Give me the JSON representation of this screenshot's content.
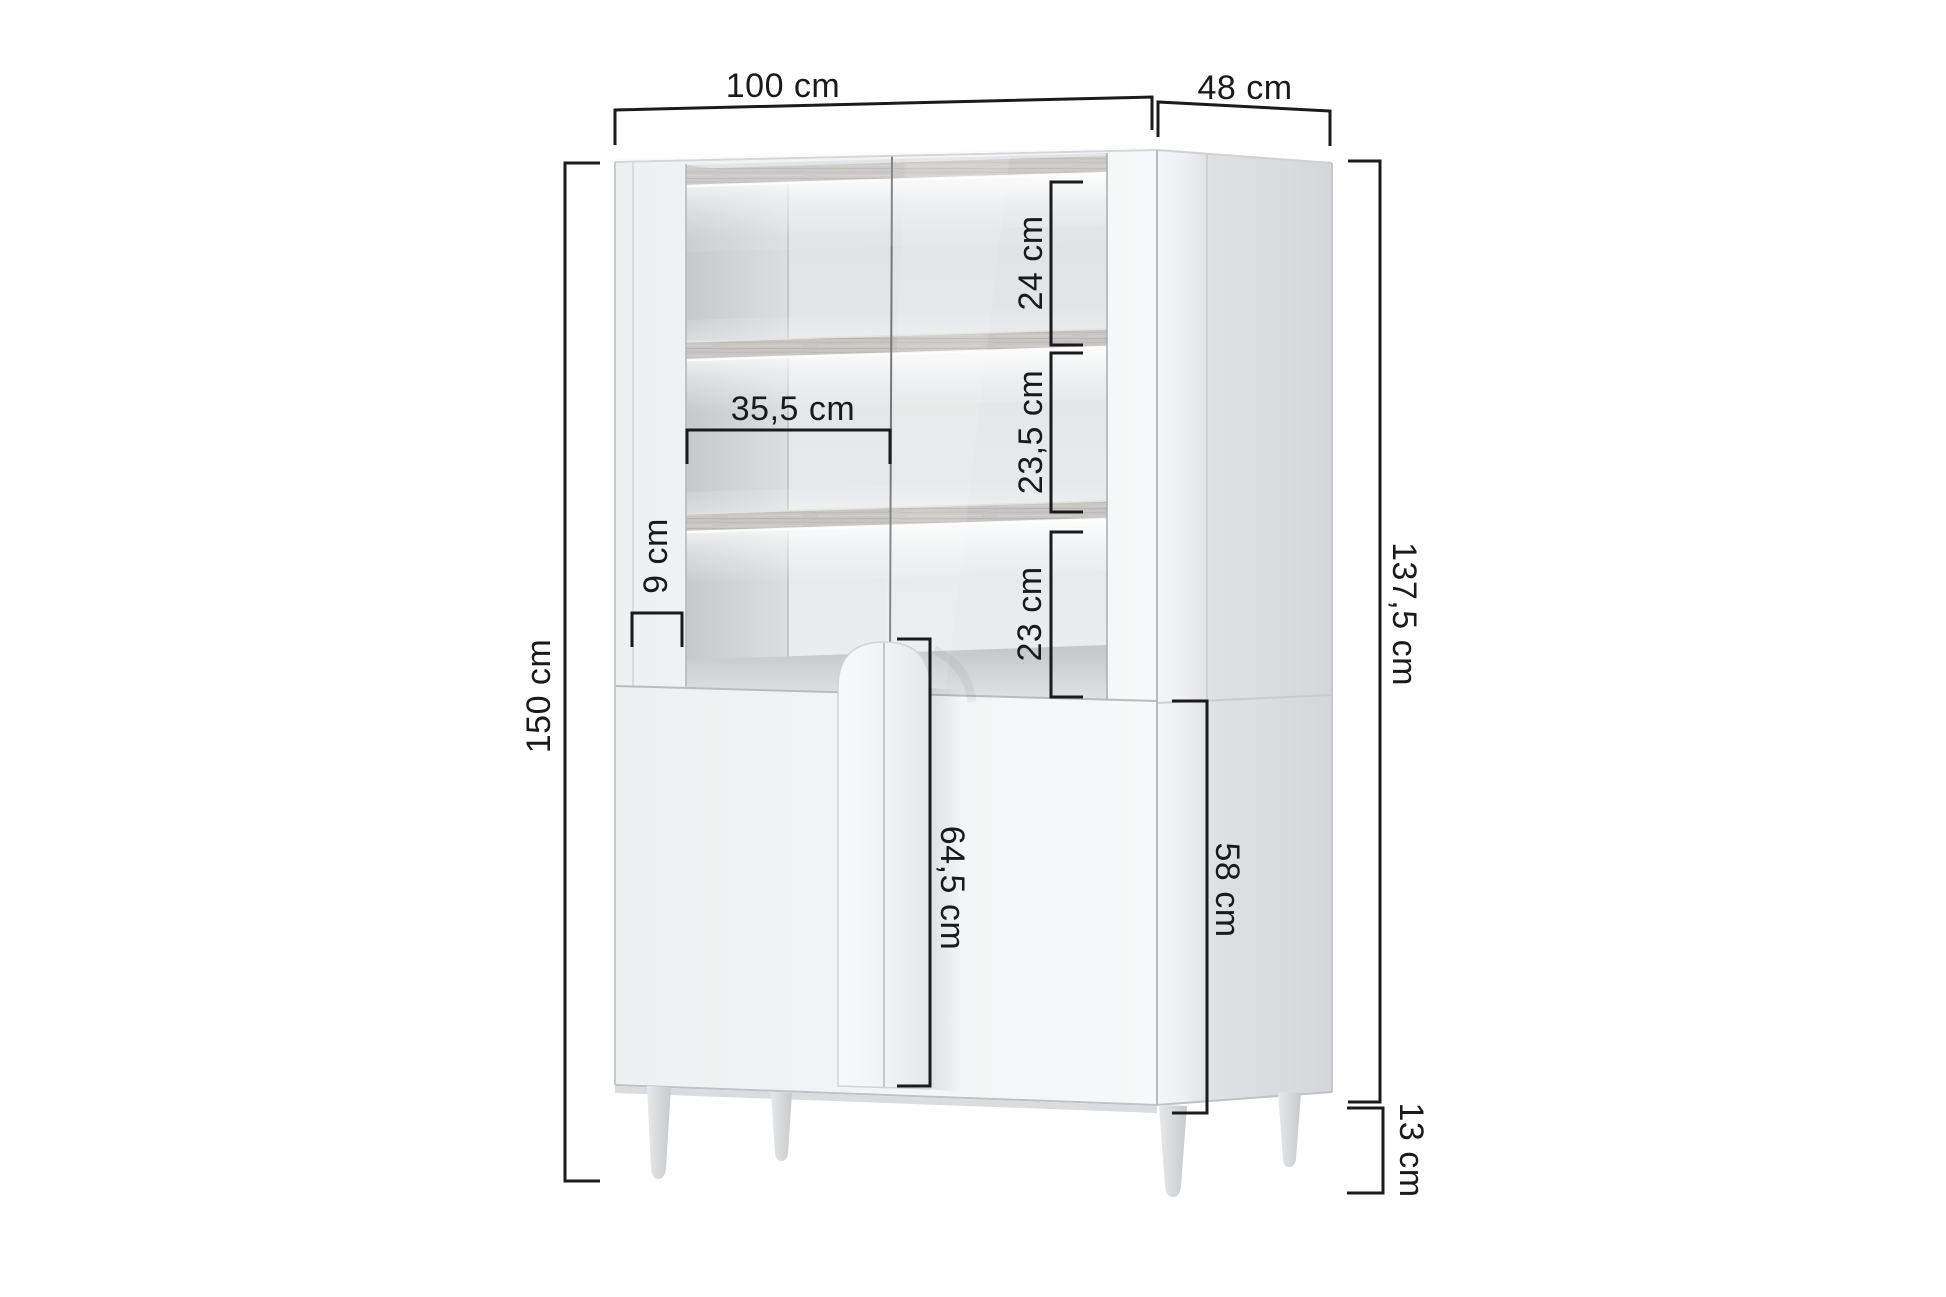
{
  "diagram": {
    "type": "furniture-dimension-diagram",
    "product": "display cabinet with glass doors, interior shelves and legs",
    "unit": "cm",
    "colors": {
      "background": "#ffffff",
      "dimension_line": "#1b1b1d",
      "dimension_text": "#1a1a1a",
      "cabinet_front": "#f3f4f5",
      "cabinet_side": "#d9dadc",
      "shelf_wood": "#c8c6c2",
      "led_glow": "#ffffff"
    },
    "labels": {
      "total_width": "100 cm",
      "total_depth": "48 cm",
      "total_height": "150 cm",
      "body_height": "137,5 cm",
      "leg_height": "13 cm",
      "top_shelf_gap": "24 cm",
      "middle_shelf_gap": "23,5 cm",
      "bottom_shelf_gap": "23 cm",
      "glass_door_width": "35,5 cm",
      "side_frame_width": "9 cm",
      "door_height": "64,5 cm",
      "base_side_height": "58 cm"
    }
  }
}
